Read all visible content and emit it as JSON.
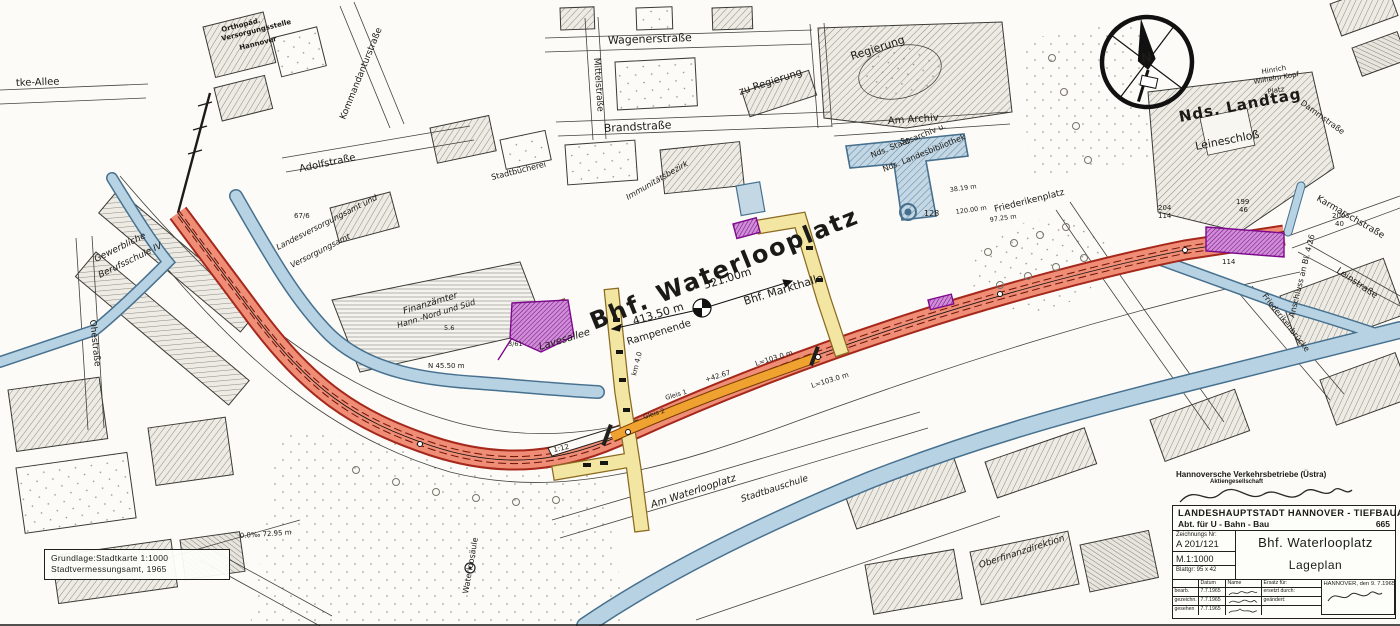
{
  "compass": {
    "n": "N"
  },
  "basemap_note": {
    "line1": "Grundlage:Stadtkarte  1:1000",
    "line2": "Stadtvermessungsamt, 1965"
  },
  "operator": {
    "line1": "Hannoversche Verkehrsbetriebe (Üstra)",
    "line2": "Aktiengesellschaft"
  },
  "title_block": {
    "agency": "LANDESHAUPTSTADT HANNOVER - TIEFBAUAMT",
    "department": "Abt. für U - Bahn - Bau",
    "dept_no": "665",
    "drawing_no_label": "Zeichnungs Nr:",
    "drawing_no": "A 201/121",
    "scale": "M.1:1000",
    "sheet": "Blattgr: 95 x 42",
    "title": "Bhf. Waterlooplatz",
    "subtitle": "Lageplan",
    "col_datum": "Datum",
    "col_name": "Name",
    "rows": [
      {
        "label": "bearb.",
        "date": "7.7.1965"
      },
      {
        "label": "gezeichn.",
        "date": "7.7.1965"
      },
      {
        "label": "gesehen",
        "date": "7.7.1965"
      }
    ],
    "ersatz": "Ersatz für:",
    "ersetzt": "ersetzt durch:",
    "geaendert": "geändert:",
    "place_date": "HANNOVER, den 9. 7.1965"
  },
  "colors": {
    "tunnel_red": "#ef8d76",
    "tunnel_casing": "#a5281b",
    "platform_orange": "#f0a231",
    "street_yellow": "#f3e6a3",
    "structure_purple": "#8d0f9c",
    "water_fill": "#b7d2e3",
    "water_edge": "#47718f",
    "ink": "#22201c"
  },
  "map": {
    "labels": [
      {
        "t": "Bhf. Waterlooplatz",
        "x": 594,
        "y": 330,
        "r": -22,
        "s": 24,
        "ls": 2,
        "w": 1
      },
      {
        "t": "521.00m",
        "x": 705,
        "y": 289,
        "r": -17,
        "s": 11
      },
      {
        "t": "Bhf. Markthalle",
        "x": 745,
        "y": 305,
        "r": -17,
        "s": 11
      },
      {
        "t": "413.50 m",
        "x": 634,
        "y": 325,
        "r": -17,
        "s": 11
      },
      {
        "t": "Rampenende",
        "x": 628,
        "y": 345,
        "r": -17,
        "s": 10
      },
      {
        "t": "Nds. Landtag",
        "x": 1180,
        "y": 122,
        "r": -11,
        "s": 15,
        "f": "se",
        "w": 1,
        "ls": 1
      },
      {
        "t": "Leineschloß",
        "x": 1196,
        "y": 150,
        "r": -11,
        "s": 11,
        "f": "se"
      },
      {
        "t": "Regierung",
        "x": 852,
        "y": 60,
        "r": -18,
        "s": 11,
        "f": "se"
      },
      {
        "t": "zu Regierung",
        "x": 740,
        "y": 95,
        "r": -18,
        "s": 10,
        "f": "se"
      },
      {
        "t": "Am Archiv",
        "x": 888,
        "y": 124,
        "r": -4,
        "s": 10,
        "f": "se"
      },
      {
        "t": "Nds. Staatsarchiv u.",
        "x": 872,
        "y": 158,
        "r": -22,
        "s": 8,
        "f": "se"
      },
      {
        "t": "Nds. Landesbibliothek",
        "x": 884,
        "y": 172,
        "r": -22,
        "s": 8,
        "f": "se"
      },
      {
        "t": "Friederikenplatz",
        "x": 995,
        "y": 212,
        "r": -14,
        "s": 9,
        "f": "se"
      },
      {
        "t": "Friederikenbrücke",
        "x": 1262,
        "y": 296,
        "r": 52,
        "s": 8,
        "f": "se"
      },
      {
        "t": "Wagenerstraße",
        "x": 608,
        "y": 44,
        "r": -2,
        "s": 11,
        "f": "se"
      },
      {
        "t": "Brandstraße",
        "x": 604,
        "y": 132,
        "r": -3,
        "s": 11,
        "f": "se"
      },
      {
        "t": "Mittelstraße",
        "x": 594,
        "y": 58,
        "r": 86,
        "s": 9,
        "f": "se"
      },
      {
        "t": "Kommandanturstraße",
        "x": 345,
        "y": 120,
        "r": -68,
        "s": 9,
        "f": "se"
      },
      {
        "t": "Adolfstraße",
        "x": 300,
        "y": 172,
        "r": -12,
        "s": 10,
        "f": "se"
      },
      {
        "t": "Orthopäd.",
        "x": 222,
        "y": 32,
        "r": -14,
        "s": 7,
        "w": 1
      },
      {
        "t": "Versorgungsstelle",
        "x": 222,
        "y": 41,
        "r": -14,
        "s": 7,
        "w": 1
      },
      {
        "t": "Hannover",
        "x": 240,
        "y": 50,
        "r": -14,
        "s": 7,
        "w": 1
      },
      {
        "t": "tke-Allee",
        "x": 16,
        "y": 86,
        "r": -2,
        "s": 10,
        "f": "se"
      },
      {
        "t": "Gewerbliche",
        "x": 96,
        "y": 262,
        "r": -26,
        "s": 9,
        "f": "se",
        "i": 1
      },
      {
        "t": "Berufsschule IV",
        "x": 100,
        "y": 278,
        "r": -26,
        "s": 9,
        "f": "se",
        "i": 1
      },
      {
        "t": "Ohestraße",
        "x": 90,
        "y": 320,
        "r": 84,
        "s": 9,
        "f": "se"
      },
      {
        "t": "Finanzämter",
        "x": 404,
        "y": 314,
        "r": -17,
        "s": 9,
        "f": "se",
        "i": 1
      },
      {
        "t": "Hann.-Nord und Süd",
        "x": 398,
        "y": 328,
        "r": -17,
        "s": 8,
        "f": "se",
        "i": 1
      },
      {
        "t": "Lavesallee",
        "x": 540,
        "y": 350,
        "r": -17,
        "s": 10,
        "f": "se",
        "i": 1
      },
      {
        "t": "Landesversorgungsamt und",
        "x": 278,
        "y": 250,
        "r": -27,
        "s": 8,
        "f": "se",
        "i": 1
      },
      {
        "t": "Versorgungsamt",
        "x": 292,
        "y": 268,
        "r": -27,
        "s": 8,
        "f": "se",
        "i": 1
      },
      {
        "t": "Am Waterlooplatz",
        "x": 652,
        "y": 508,
        "r": -18,
        "s": 10,
        "f": "se",
        "i": 1
      },
      {
        "t": "Waterloosäule",
        "x": 468,
        "y": 594,
        "r": -80,
        "s": 8,
        "f": "se"
      },
      {
        "t": "Stadtbauschule",
        "x": 742,
        "y": 502,
        "r": -18,
        "s": 9,
        "f": "se",
        "i": 1
      },
      {
        "t": "Oberfinanzdirektion",
        "x": 980,
        "y": 568,
        "r": -18,
        "s": 9,
        "f": "se",
        "i": 1
      },
      {
        "t": "Hinrich",
        "x": 1262,
        "y": 74,
        "r": -10,
        "s": 7,
        "f": "se"
      },
      {
        "t": "Wilhelm Kopf",
        "x": 1254,
        "y": 84,
        "r": -10,
        "s": 7,
        "f": "se"
      },
      {
        "t": "Platz",
        "x": 1268,
        "y": 94,
        "r": -10,
        "s": 7,
        "f": "se"
      },
      {
        "t": "Dammstraße",
        "x": 1300,
        "y": 104,
        "r": 36,
        "s": 8,
        "f": "se"
      },
      {
        "t": "Karmarschstraße",
        "x": 1316,
        "y": 200,
        "r": 30,
        "s": 9,
        "f": "se"
      },
      {
        "t": "Leinstraße",
        "x": 1336,
        "y": 272,
        "r": 34,
        "s": 9,
        "f": "se"
      },
      {
        "t": "Anschluss an Bl. 4.26",
        "x": 1294,
        "y": 318,
        "r": -76,
        "s": 8
      },
      {
        "t": "Stadtbücherei",
        "x": 492,
        "y": 180,
        "r": -14,
        "s": 8,
        "f": "se"
      },
      {
        "t": "Immunitätsbezirk",
        "x": 628,
        "y": 200,
        "r": -30,
        "s": 8,
        "f": "se",
        "i": 1
      },
      {
        "t": "L=103.0 m",
        "x": 756,
        "y": 366,
        "r": -17,
        "s": 7
      },
      {
        "t": "L=103.0 m",
        "x": 812,
        "y": 388,
        "r": -17,
        "s": 7
      },
      {
        "t": "+42.67",
        "x": 706,
        "y": 382,
        "r": -17,
        "s": 7
      },
      {
        "t": "Gleis 1",
        "x": 666,
        "y": 400,
        "r": -17,
        "s": 6.5
      },
      {
        "t": "Gleis 2",
        "x": 644,
        "y": 419,
        "r": -17,
        "s": 6.5
      },
      {
        "t": "km 4.0",
        "x": 636,
        "y": 376,
        "r": -76,
        "s": 7
      },
      {
        "t": "1:12",
        "x": 554,
        "y": 452,
        "r": -12,
        "s": 7
      },
      {
        "t": "N 45.50 m",
        "x": 428,
        "y": 368,
        "r": 0,
        "s": 7
      },
      {
        "t": "128",
        "x": 924,
        "y": 216,
        "r": 0,
        "s": 8
      },
      {
        "t": "50",
        "x": 900,
        "y": 144,
        "r": 0,
        "s": 8
      },
      {
        "t": "204",
        "x": 1158,
        "y": 210,
        "r": 0,
        "s": 7
      },
      {
        "t": "114",
        "x": 1158,
        "y": 218,
        "r": 0,
        "s": 7
      },
      {
        "t": "199",
        "x": 1236,
        "y": 204,
        "r": 0,
        "s": 7
      },
      {
        "t": "46",
        "x": 1239,
        "y": 212,
        "r": 0,
        "s": 7
      },
      {
        "t": "200",
        "x": 1332,
        "y": 218,
        "r": 0,
        "s": 7
      },
      {
        "t": "40",
        "x": 1335,
        "y": 226,
        "r": 0,
        "s": 7
      },
      {
        "t": "67/6",
        "x": 294,
        "y": 218,
        "r": 0,
        "s": 7
      },
      {
        "t": "114",
        "x": 1222,
        "y": 264,
        "r": 0,
        "s": 7
      },
      {
        "t": "38.19 m",
        "x": 950,
        "y": 192,
        "r": -8,
        "s": 6.5
      },
      {
        "t": "120.00 m",
        "x": 956,
        "y": 214,
        "r": -8,
        "s": 6.5
      },
      {
        "t": "97.25 m",
        "x": 990,
        "y": 222,
        "r": -8,
        "s": 6.5
      },
      {
        "t": "0.0‰  72.95 m",
        "x": 240,
        "y": 538,
        "r": -4,
        "s": 7
      },
      {
        "t": "5.6",
        "x": 444,
        "y": 330,
        "r": 0,
        "s": 6.5
      },
      {
        "t": "3/61",
        "x": 508,
        "y": 346,
        "r": 0,
        "s": 6.5
      }
    ]
  }
}
